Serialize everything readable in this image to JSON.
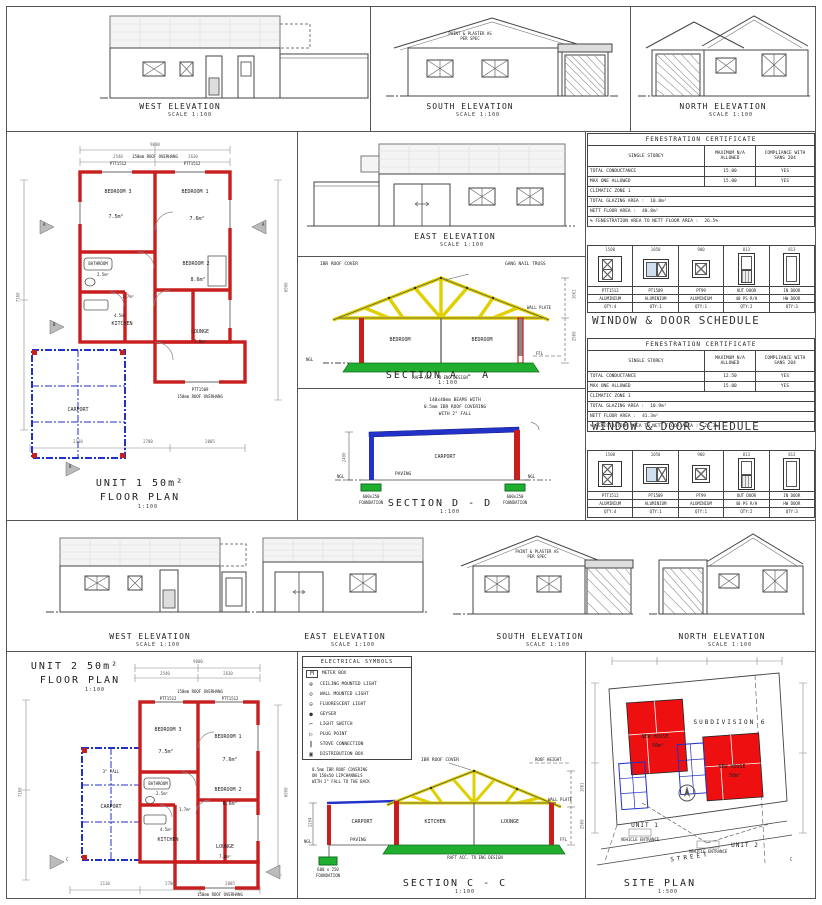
{
  "labels": {
    "ngl": "NGL",
    "ffl": "FFL"
  },
  "unit1": {
    "elev_west": {
      "title": "WEST ELEVATION",
      "scale": "SCALE 1:100"
    },
    "elev_south": {
      "title": "SOUTH ELEVATION",
      "scale": "SCALE 1:100",
      "note": "PAINT & PLASTER AS PER SPEC"
    },
    "elev_north": {
      "title": "NORTH ELEVATION",
      "scale": "SCALE 1:100"
    },
    "elev_east": {
      "title": "EAST ELEVATION",
      "scale": "SCALE 1:100"
    },
    "plan": {
      "title": "UNIT 1 50m²",
      "subtitle": "FLOOR PLAN",
      "scale": "1:100",
      "rooms": {
        "bed3": {
          "name": "BEDROOM 3",
          "area": "7.5m²"
        },
        "bed1": {
          "name": "BEDROOM 1",
          "area": "7.6m²"
        },
        "bath": {
          "name": "BATHROOM",
          "area": "2.5m²"
        },
        "bed2": {
          "name": "BEDROOM 2",
          "area": "8.6m²"
        },
        "wc": {
          "area": "1.7m²"
        },
        "kitchen": {
          "name": "KITCHEN",
          "area": "4.5m²"
        },
        "lounge": {
          "name": "LOUNGE",
          "area": "7.0m²"
        },
        "carport": {
          "name": "CARPORT"
        }
      },
      "notes": {
        "overhang_top": "150mm ROOF OVERHANG",
        "overhang_bottom": "150mm ROOF OVERHANG",
        "win_a": "PTT1512",
        "win_b": "PTT1512",
        "win_c": "PTT1509"
      },
      "dims": {
        "top_total": "9000",
        "top_a": "2540",
        "top_b": "2630",
        "left_total": "7160",
        "right_total": "6000",
        "bot_a": "2110",
        "bot_b": "2700",
        "bot_c": "2005"
      },
      "marker_a": "A",
      "marker_b": "B",
      "marker_d": "D"
    }
  },
  "section_aa": {
    "title": "SECTION A - A",
    "scale": "1:100",
    "note_roof": "IBR ROOF COVER",
    "note_truss": "GANG NAIL TRUSS",
    "note_wallplate": "WALL PLATE",
    "room_left": "BEDROOM",
    "room_right": "BEDROOM",
    "note_raft": "RAFT ACC. TO ENG DESIGN",
    "dim_roof": "1061",
    "dim_wall": "2560"
  },
  "section_dd": {
    "title": "SECTION D - D",
    "scale": "1:100",
    "note_beam1": "140x40mm BEAMS WITH",
    "note_beam2": "0.5mm IBR ROOF COVERING",
    "note_beam3": "WITH 2° FALL",
    "room": "CARPORT",
    "paving": "PAVING",
    "found_left1": "600x250",
    "found_left2": "FOUNDATION",
    "found_right1": "600x250",
    "found_right2": "FOUNDATION",
    "dim_height": "2400"
  },
  "fenestration1": {
    "title": "FENESTRATION CERTIFICATE",
    "col_headers": [
      "SINGLE STOREY",
      "MAXIMUM N/A ALLOWED",
      "COMPLIANCE WITH SANS 204"
    ],
    "rows": [
      [
        "TOTAL CONDUCTANCE",
        "15.00",
        "YES"
      ],
      [
        "MAX ONE ALLOWED",
        "15.00",
        "YES"
      ]
    ],
    "zone": "CLIMATIC ZONE 1",
    "glazing_label": "TOTAL GLAZING AREA :",
    "glazing_value": "10.8m²",
    "floor_label": "NETT FLOOR AREA :",
    "floor_value": "40.8m²",
    "pct_label": "% FENESTRATION AREA TO NETT FLOOR AREA :",
    "pct_value": "26.5%"
  },
  "schedule1": {
    "title": "WINDOW & DOOR SCHEDULE",
    "columns": [
      {
        "dim": "1500",
        "code": "PTT1512",
        "material": "ALUMINIUM",
        "qty": "QTY:4"
      },
      {
        "dim": "1050",
        "code": "PT1509",
        "material": "ALUMINIUM",
        "qty": "QTY:1"
      },
      {
        "dim": "900",
        "code": "PT99",
        "material": "ALUMINIUM",
        "qty": "QTY:1"
      },
      {
        "dim": "813",
        "code": "OUT DOOR",
        "material": "40 PS R/H",
        "qty": "QTY:2"
      },
      {
        "dim": "813",
        "code": "IN DOOR",
        "material": "HW DOOR",
        "qty": "QTY:3"
      }
    ]
  },
  "fenestration2": {
    "title": "FENESTRATION CERTIFICATE",
    "col_headers": [
      "SINGLE STOREY",
      "MAXIMUM N/A ALLOWED",
      "COMPLIANCE WITH SANS 204"
    ],
    "rows": [
      [
        "TOTAL CONDUCTANCE",
        "12.50",
        "YES"
      ],
      [
        "MAX ONE ALLOWED",
        "15.00",
        "YES"
      ]
    ],
    "zone": "CLIMATIC ZONE 1",
    "glazing_label": "TOTAL GLAZING AREA :",
    "glazing_value": "10.9m²",
    "floor_label": "NETT FLOOR AREA :",
    "floor_value": "41.3m²",
    "pct_label": "% FENESTRATION AREA TO NETT FLOOR AREA :",
    "pct_value": "26.3%"
  },
  "schedule2": {
    "title": "WINDOW & DOOR SCHEDULE",
    "columns": [
      {
        "dim": "1500",
        "code": "PTT1512",
        "material": "ALUMINIUM",
        "qty": "QTY:4"
      },
      {
        "dim": "1050",
        "code": "PT1509",
        "material": "ALUMINIUM",
        "qty": "QTY:1"
      },
      {
        "dim": "900",
        "code": "PT99",
        "material": "ALUMINIUM",
        "qty": "QTY:1"
      },
      {
        "dim": "813",
        "code": "OUT DOOR",
        "material": "40 PS R/H",
        "qty": "QTY:2"
      },
      {
        "dim": "813",
        "code": "IN DOOR",
        "material": "HW DOOR",
        "qty": "QTY:3"
      }
    ]
  },
  "unit2": {
    "elev_west": {
      "title": "WEST ELEVATION",
      "scale": "SCALE 1:100"
    },
    "elev_east": {
      "title": "EAST ELEVATION",
      "scale": "SCALE 1:100"
    },
    "elev_south": {
      "title": "SOUTH ELEVATION",
      "scale": "SCALE 1:100",
      "note": "PAINT & PLASTER AS PER SPEC"
    },
    "elev_north": {
      "title": "NORTH ELEVATION",
      "scale": "SCALE 1:100"
    },
    "plan": {
      "title": "UNIT 2 50m²",
      "subtitle": "FLOOR PLAN",
      "scale": "1:100",
      "rooms": {
        "bed3": {
          "name": "BEDROOM 3",
          "area": "7.5m²"
        },
        "bed1": {
          "name": "BEDROOM 1",
          "area": "7.6m²"
        },
        "bath": {
          "name": "BATHROOM",
          "area": "2.5m²"
        },
        "bed2": {
          "name": "BEDROOM 2",
          "area": "8.6m²"
        },
        "wc": {
          "area": "1.7m²"
        },
        "kitchen": {
          "name": "KITCHEN",
          "area": "4.5m²"
        },
        "lounge": {
          "name": "LOUNGE",
          "area": "7.0m²"
        },
        "carport": {
          "name": "CARPORT",
          "fall": "3° FALL"
        }
      },
      "notes": {
        "overhang_top": "150mm ROOF OVERHANG",
        "overhang_bottom": "150mm ROOF OVERHANG",
        "win_a": "PTT1512",
        "win_b": "PTT1512"
      },
      "dims": {
        "top_total": "9000",
        "top_a": "2540",
        "top_b": "2630",
        "left_total": "7160",
        "right_total": "6000",
        "bot_a": "2110",
        "bot_b": "2700",
        "bot_c": "2005"
      },
      "marker_c": "C"
    }
  },
  "legend": {
    "title": "ELECTRICAL SYMBOLS",
    "items": [
      {
        "symbol": "M",
        "label": "METER BOX"
      },
      {
        "symbol": "⊕",
        "label": "CEILING MOUNTED LIGHT"
      },
      {
        "symbol": "⊙",
        "label": "WALL MOUNTED LIGHT"
      },
      {
        "symbol": "⊖",
        "label": "FLUORESCENT LIGHT"
      },
      {
        "symbol": "●",
        "label": "GEYSER"
      },
      {
        "symbol": "⌐",
        "label": "LIGHT SWITCH"
      },
      {
        "symbol": "▷",
        "label": "PLUG POINT"
      },
      {
        "symbol": "‖",
        "label": "STOVE CONNECTION"
      },
      {
        "symbol": "▣",
        "label": "DISTRIBUTION BOX"
      }
    ]
  },
  "section_cc": {
    "title": "SECTION C - C",
    "scale": "1:100",
    "note_roof": "IBR ROOF COVER",
    "note_roofheight": "ROOF HEIGHT",
    "note_cover1": "0.5mm IBR ROOF COVERING",
    "note_cover2": "ON 150x50 LIPCHANNELS",
    "note_cover3": "WITH 2° FALL TO THE BACK",
    "note_wallplate": "WALL PLATE",
    "room_carport": "CARPORT",
    "room_kitchen": "KITCHEN",
    "room_lounge": "LOUNGE",
    "paving": "PAVING",
    "note_raft": "RAFT ACC. TO ENG DESIGN",
    "found1": "600 x 250",
    "found2": "FOUNDATION",
    "dim_roof": "1061",
    "dim_wall": "2560",
    "dim_carport": "2204"
  },
  "site_plan": {
    "title": "SITE PLAN",
    "scale": "1:500",
    "subdivision": "SUBDIVISION 6",
    "house1_label": "NEW HOUSE",
    "house1_area": "50m²",
    "house2_label": "NEW HOUSE",
    "house2_area": "50m²",
    "unit1": "UNIT 1",
    "unit2": "UNIT 2",
    "entrance1": "VEHICLE ENTRANCE",
    "entrance2": "VEHICLE ENTRANCE",
    "street": "STREET"
  }
}
